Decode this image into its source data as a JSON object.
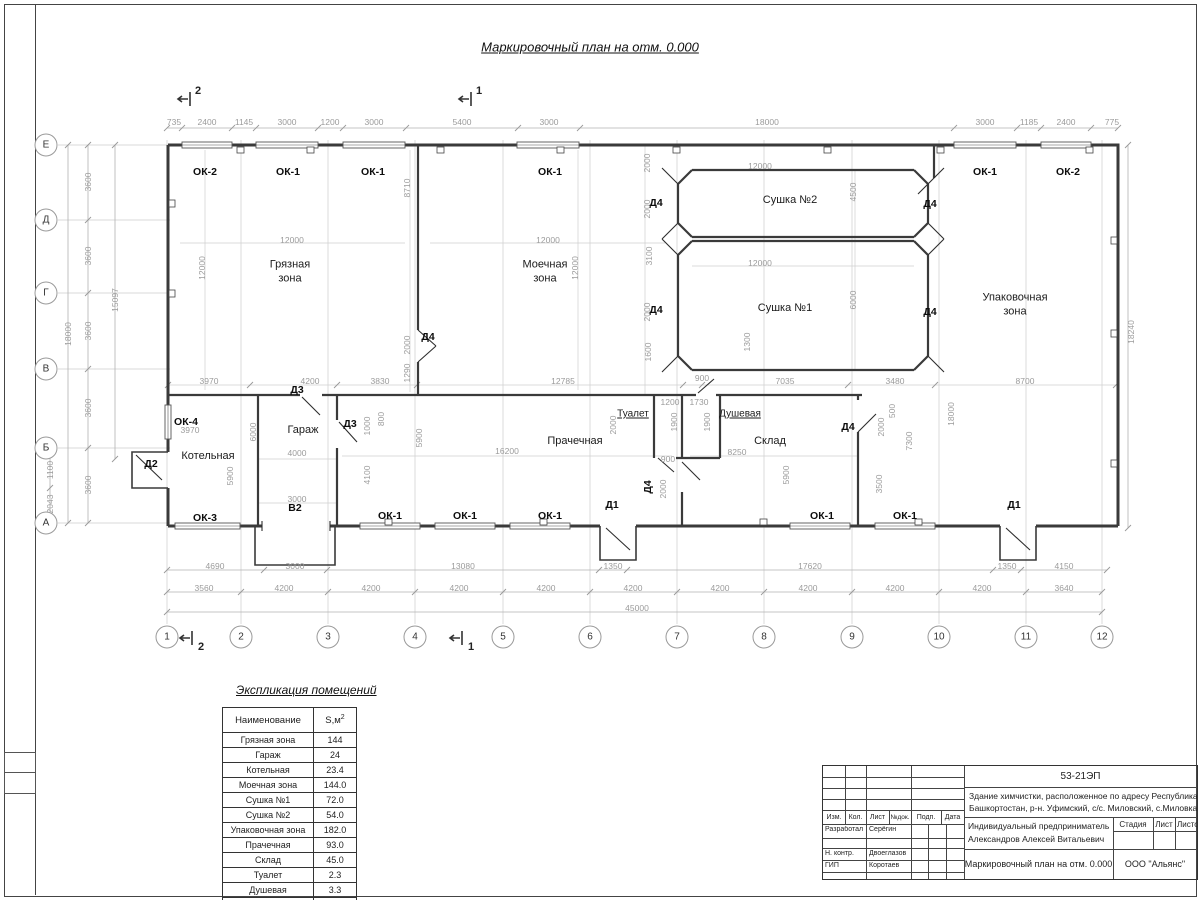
{
  "sheet_title": "Маркировочный план на отм. 0.000",
  "schedule": {
    "title": "Экспликация помещений",
    "headers": [
      "Наименование",
      "S,м2"
    ],
    "rows": [
      [
        "Грязная зона",
        "144"
      ],
      [
        "Гараж",
        "24"
      ],
      [
        "Котельная",
        "23.4"
      ],
      [
        "Моечная зона",
        "144.0"
      ],
      [
        "Сушка №1",
        "72.0"
      ],
      [
        "Сушка №2",
        "54.0"
      ],
      [
        "Упаковочная зона",
        "182.0"
      ],
      [
        "Прачечная",
        "93.0"
      ],
      [
        "Склад",
        "45.0"
      ],
      [
        "Туалет",
        "2.3"
      ],
      [
        "Душевая",
        "3.3"
      ],
      [
        "",
        "786.99"
      ]
    ]
  },
  "title_block": {
    "doc_number": "53-21ЭП",
    "object_desc": "Здание химчистки,  расположенное по адресу Республика Башкортостан, р-н. Уфимский, с/с. Миловский, с.Миловка",
    "header_cols": [
      "Изм.",
      "Кол.",
      "Лист",
      "№док.",
      "Подп.",
      "Дата"
    ],
    "client_line1": "Индивидуальный предприниматель",
    "client_line2": "Александров Алексей Витальевич",
    "stage_label": "Стадия",
    "sheet_label": "Лист",
    "sheets_label": "Листов",
    "role_developed": "Разработал",
    "name_developed": "Серёгин",
    "role_ncontrol": "Н. контр.",
    "name_ncontrol": "Двоеглазов",
    "role_gip": "ГИП",
    "name_gip": "Коротаев",
    "drawing_name": "Маркировочный план на отм. 0.000",
    "company": "ООО \"Альянс\""
  },
  "plan_labels": [
    [
      "room",
      "Грязная\nзона",
      290,
      272
    ],
    [
      "room",
      "Моечная\nзона",
      545,
      272
    ],
    [
      "room",
      "Сушка №2",
      790,
      200
    ],
    [
      "room",
      "Сушка №1",
      785,
      308
    ],
    [
      "room",
      "Упаковочная\nзона",
      1015,
      305
    ],
    [
      "room",
      "Гараж",
      303,
      430
    ],
    [
      "room",
      "Котельная",
      208,
      456
    ],
    [
      "room",
      "Прачечная",
      575,
      441
    ],
    [
      "roomu",
      "Туалет",
      633,
      414
    ],
    [
      "roomu",
      "Душевая",
      740,
      414
    ],
    [
      "room",
      "Склад",
      770,
      441
    ],
    [
      "win",
      "ОК-2",
      205,
      172
    ],
    [
      "win",
      "ОК-1",
      288,
      172
    ],
    [
      "win",
      "ОК-1",
      373,
      172
    ],
    [
      "win",
      "ОК-1",
      550,
      172
    ],
    [
      "win",
      "ОК-1",
      985,
      172
    ],
    [
      "win",
      "ОК-2",
      1068,
      172
    ],
    [
      "win",
      "ОК-4",
      186,
      422
    ],
    [
      "win",
      "ОК-3",
      205,
      518
    ],
    [
      "win",
      "ОК-1",
      390,
      516
    ],
    [
      "win",
      "ОК-1",
      465,
      516
    ],
    [
      "win",
      "ОК-1",
      550,
      516
    ],
    [
      "win",
      "ОК-1",
      822,
      516
    ],
    [
      "win",
      "ОК-1",
      905,
      516
    ],
    [
      "win",
      "В2",
      295,
      508
    ],
    [
      "door",
      "Д2",
      151,
      464
    ],
    [
      "door",
      "Д3",
      297,
      390
    ],
    [
      "door",
      "Д3",
      350,
      424
    ],
    [
      "door",
      "Д4",
      428,
      337
    ],
    [
      "door",
      "Д4",
      656,
      203
    ],
    [
      "door",
      "Д4",
      930,
      204
    ],
    [
      "door",
      "Д4",
      656,
      310
    ],
    [
      "door",
      "Д4",
      930,
      312
    ],
    [
      "door",
      "Д4",
      848,
      427
    ],
    [
      "doorv",
      "Д4",
      648,
      487
    ],
    [
      "door",
      "Д1",
      612,
      505
    ],
    [
      "door",
      "Д1",
      1014,
      505
    ],
    [
      "sec",
      "2",
      198,
      91
    ],
    [
      "sec",
      "1",
      479,
      91
    ],
    [
      "sec",
      "2",
      201,
      647
    ],
    [
      "sec",
      "1",
      471,
      647
    ],
    [
      "dim",
      "735",
      174,
      122
    ],
    [
      "dim",
      "2400",
      207,
      122
    ],
    [
      "dim",
      "1145",
      244,
      122
    ],
    [
      "dim",
      "3000",
      287,
      122
    ],
    [
      "dim",
      "1200",
      330,
      122
    ],
    [
      "dim",
      "3000",
      374,
      122
    ],
    [
      "dim",
      "5400",
      462,
      122
    ],
    [
      "dim",
      "3000",
      549,
      122
    ],
    [
      "dim",
      "18000",
      767,
      122
    ],
    [
      "dim",
      "3000",
      985,
      122
    ],
    [
      "dim",
      "1185",
      1029,
      122
    ],
    [
      "dim",
      "2400",
      1066,
      122
    ],
    [
      "dim",
      "775",
      1112,
      122
    ],
    [
      "dim",
      "4690",
      215,
      566
    ],
    [
      "dim",
      "3000",
      295,
      566
    ],
    [
      "dim",
      "13080",
      463,
      566
    ],
    [
      "dim",
      "1350",
      613,
      566
    ],
    [
      "dim",
      "17620",
      810,
      566
    ],
    [
      "dim",
      "1350",
      1007,
      566
    ],
    [
      "dim",
      "4150",
      1064,
      566
    ],
    [
      "dim",
      "3560",
      204,
      588
    ],
    [
      "dim",
      "4200",
      284,
      588
    ],
    [
      "dim",
      "4200",
      371,
      588
    ],
    [
      "dim",
      "4200",
      459,
      588
    ],
    [
      "dim",
      "4200",
      546,
      588
    ],
    [
      "dim",
      "4200",
      633,
      588
    ],
    [
      "dim",
      "4200",
      720,
      588
    ],
    [
      "dim",
      "4200",
      808,
      588
    ],
    [
      "dim",
      "4200",
      895,
      588
    ],
    [
      "dim",
      "4200",
      982,
      588
    ],
    [
      "dim",
      "3640",
      1064,
      588
    ],
    [
      "dim",
      "45000",
      637,
      608
    ],
    [
      "dim",
      "3970",
      209,
      381
    ],
    [
      "dim",
      "4200",
      310,
      381
    ],
    [
      "dim",
      "3830",
      380,
      381
    ],
    [
      "dim",
      "12785",
      563,
      381
    ],
    [
      "dim",
      "900",
      702,
      378
    ],
    [
      "dim",
      "7035",
      785,
      381
    ],
    [
      "dim",
      "3480",
      895,
      381
    ],
    [
      "dim",
      "8700",
      1025,
      381
    ],
    [
      "dim",
      "12000",
      292,
      240
    ],
    [
      "dim",
      "12000",
      548,
      240
    ],
    [
      "dim",
      "12000",
      760,
      166
    ],
    [
      "dim",
      "12000",
      760,
      263
    ],
    [
      "dim",
      "4000",
      297,
      453
    ],
    [
      "dim",
      "3000",
      297,
      499
    ],
    [
      "dim",
      "16200",
      507,
      451
    ],
    [
      "dim",
      "8250",
      737,
      452
    ],
    [
      "dim",
      "1200",
      670,
      402
    ],
    [
      "dim",
      "1730",
      699,
      402
    ],
    [
      "dim",
      "900",
      668,
      459
    ],
    [
      "dim",
      "3970",
      190,
      430
    ],
    [
      "dimv",
      "3600",
      88,
      182
    ],
    [
      "dimv",
      "3600",
      88,
      256
    ],
    [
      "dimv",
      "3600",
      88,
      331
    ],
    [
      "dimv",
      "3600",
      88,
      408
    ],
    [
      "dimv",
      "3600",
      88,
      485
    ],
    [
      "dimv",
      "18000",
      68,
      334
    ],
    [
      "dimv",
      "15097",
      115,
      300
    ],
    [
      "dimv",
      "1100",
      50,
      470
    ],
    [
      "dimv",
      "2043",
      50,
      504
    ],
    [
      "dimv",
      "18240",
      1131,
      332
    ],
    [
      "dimv",
      "12000",
      202,
      268
    ],
    [
      "dimv",
      "8710",
      407,
      188
    ],
    [
      "dimv",
      "2000",
      407,
      345
    ],
    [
      "dimv",
      "1290",
      407,
      373
    ],
    [
      "dimv",
      "12000",
      575,
      268
    ],
    [
      "dimv",
      "2000",
      647,
      163
    ],
    [
      "dimv",
      "2000",
      647,
      209
    ],
    [
      "dimv",
      "3100",
      649,
      256
    ],
    [
      "dimv",
      "2000",
      647,
      312
    ],
    [
      "dimv",
      "1600",
      648,
      352
    ],
    [
      "dimv",
      "4500",
      853,
      192
    ],
    [
      "dimv",
      "6000",
      853,
      300
    ],
    [
      "dimv",
      "1300",
      747,
      342
    ],
    [
      "dimv",
      "6000",
      253,
      432
    ],
    [
      "dimv",
      "5900",
      230,
      476
    ],
    [
      "dimv",
      "5900",
      419,
      438
    ],
    [
      "dimv",
      "4100",
      367,
      475
    ],
    [
      "dimv",
      "1000",
      367,
      426
    ],
    [
      "dimv",
      "800",
      381,
      419
    ],
    [
      "dimv",
      "1900",
      674,
      422
    ],
    [
      "dimv",
      "1900",
      707,
      422
    ],
    [
      "dimv",
      "2000",
      613,
      425
    ],
    [
      "dimv",
      "2000",
      663,
      489
    ],
    [
      "dimv",
      "5900",
      786,
      475
    ],
    [
      "dimv",
      "3500",
      879,
      484
    ],
    [
      "dimv",
      "2000",
      881,
      427
    ],
    [
      "dimv",
      "500",
      892,
      411
    ],
    [
      "dimv",
      "7300",
      909,
      441
    ],
    [
      "dimv",
      "18000",
      951,
      414
    ],
    [
      "axis",
      "1",
      167,
      637
    ],
    [
      "axis",
      "2",
      241,
      637
    ],
    [
      "axis",
      "3",
      328,
      637
    ],
    [
      "axis",
      "4",
      415,
      637
    ],
    [
      "axis",
      "5",
      503,
      637
    ],
    [
      "axis",
      "6",
      590,
      637
    ],
    [
      "axis",
      "7",
      677,
      637
    ],
    [
      "axis",
      "8",
      764,
      637
    ],
    [
      "axis",
      "9",
      852,
      637
    ],
    [
      "axis",
      "10",
      939,
      637
    ],
    [
      "axis",
      "11",
      1026,
      637
    ],
    [
      "axis",
      "12",
      1102,
      637
    ],
    [
      "axis",
      "Е",
      46,
      145
    ],
    [
      "axis",
      "Д",
      46,
      220
    ],
    [
      "axis",
      "Г",
      46,
      293
    ],
    [
      "axis",
      "В",
      46,
      369
    ],
    [
      "axis",
      "Б",
      46,
      448
    ],
    [
      "axis",
      "А",
      46,
      523
    ]
  ]
}
